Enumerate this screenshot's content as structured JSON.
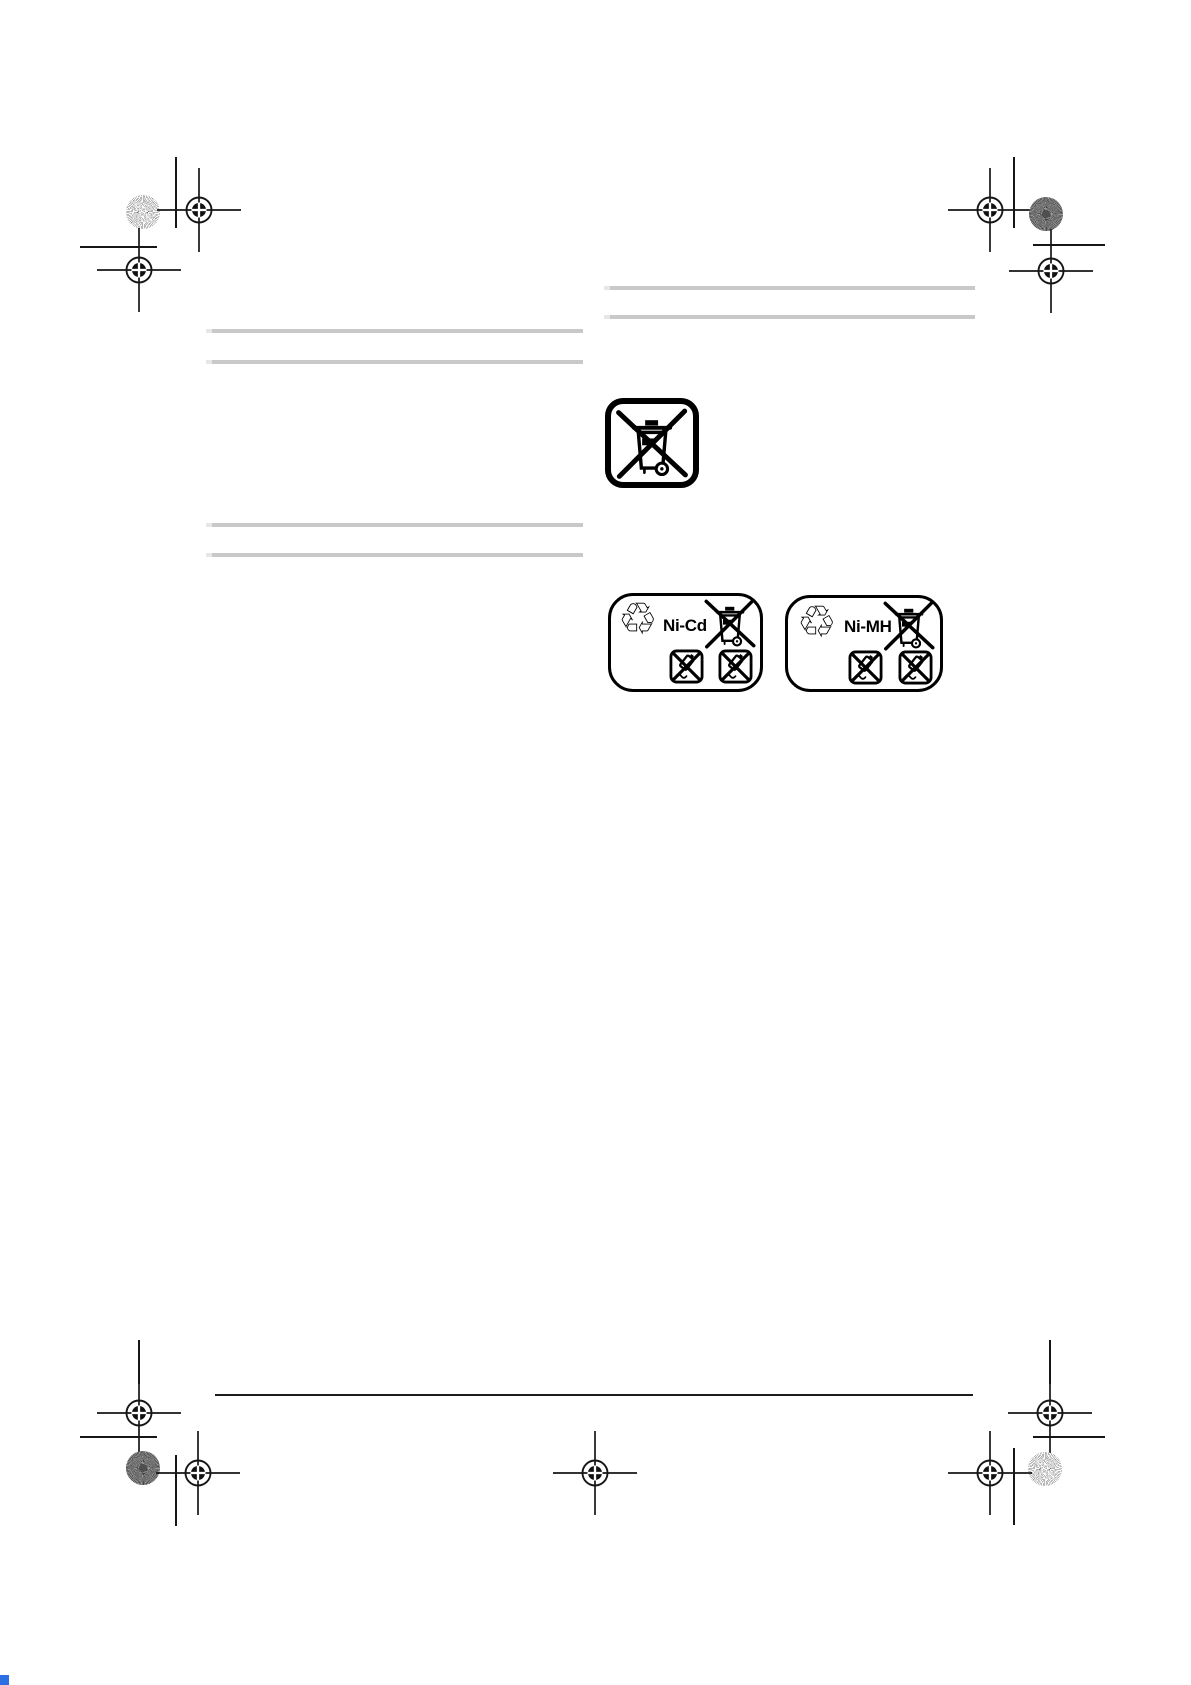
{
  "document": {
    "type": "print-proof manual page",
    "visible_text": [
      "Ni-Cd",
      "Ni-MH"
    ]
  },
  "icons": {
    "recycle_glyph": "♲",
    "names": [
      "registration-mark-icon",
      "calibration-dot-icon",
      "crop-line",
      "weee-crossed-bin-icon",
      "recycle-icon",
      "battery-warning-square-icon"
    ]
  },
  "symbols": {
    "battery_labels": [
      {
        "chemistry": "Ni-Cd"
      },
      {
        "chemistry": "Ni-MH"
      }
    ]
  },
  "placeholders": {
    "left_column_bars": 4,
    "right_column_bars": 2
  },
  "colors": {
    "background": "#ffffff",
    "ink": "#161616",
    "placeholder_bar": "#c9c9c9",
    "placeholder_bar_tip": "#e6e6e6",
    "calibration_light": "#6f6f6f",
    "calibration_dark": "#454545",
    "artifact_blue": "#2b6fe3"
  }
}
